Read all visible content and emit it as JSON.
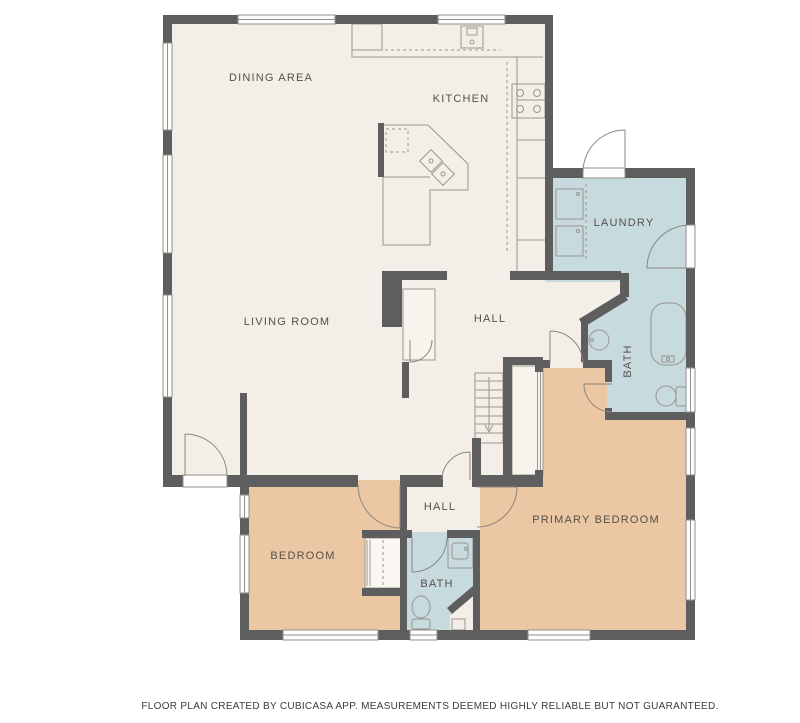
{
  "floor_plan": {
    "colors": {
      "background": "#ffffff",
      "floor": "#f4eee8",
      "wet_room": "#c7dbdf",
      "bedroom": "#ebc7a3",
      "wall": "#5f5e5e",
      "fixture": "#9a958f",
      "door": "#8a8781",
      "window_fill": "#fefdfb",
      "label": "#555049",
      "footer": "#3b3b3b"
    },
    "rooms": {
      "dining_area": {
        "label": "DINING AREA"
      },
      "kitchen": {
        "label": "KITCHEN"
      },
      "living_room": {
        "label": "LIVING ROOM"
      },
      "hall_upper": {
        "label": "HALL"
      },
      "laundry": {
        "label": "LAUNDRY"
      },
      "bath_upper": {
        "label": "BATH"
      },
      "primary_bedroom": {
        "label": "PRIMARY BEDROOM"
      },
      "bedroom": {
        "label": "BEDROOM"
      },
      "hall_lower": {
        "label": "HALL"
      },
      "bath_lower": {
        "label": "BATH"
      }
    },
    "fixtures": [
      "kitchen-sink",
      "refrigerator",
      "stove",
      "island-cooktop",
      "dishwasher",
      "washer",
      "dryer",
      "bathtub",
      "toilet",
      "round-sink",
      "vanity-sink",
      "utility-sink",
      "stairs-down-arrow",
      "closet",
      "door-swing",
      "window"
    ],
    "footer": "FLOOR PLAN CREATED BY CUBICASA APP. MEASUREMENTS DEEMED HIGHLY RELIABLE BUT NOT GUARANTEED."
  }
}
